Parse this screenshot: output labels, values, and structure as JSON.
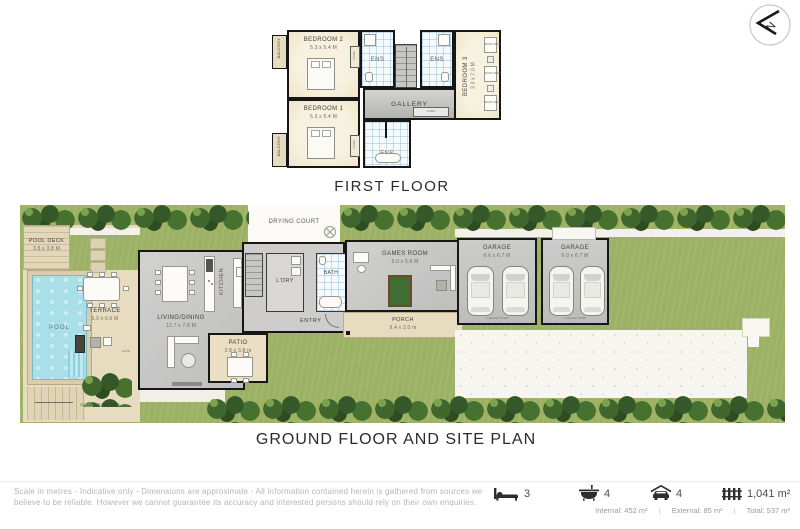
{
  "titles": {
    "first_floor": "FIRST FLOOR",
    "ground_floor": "GROUND FLOOR AND SITE PLAN"
  },
  "compass": {
    "direction": "N"
  },
  "first_floor": {
    "balcony_top": "BALCONY",
    "balcony_bottom": "BALCONY",
    "bedroom2": {
      "name": "BEDROOM 2",
      "dims": "5.3 x 5.4 M"
    },
    "bedroom1": {
      "name": "BEDROOM 1",
      "dims": "5.3 x 5.4 M"
    },
    "bedroom3": {
      "name": "BEDROOM 3",
      "dims": "3.3 x 7.0 M"
    },
    "ens_a": "ENS",
    "ens_b": "ENS",
    "ens_c": "ENS",
    "gallery": "GALLERY",
    "robe": "ROBE",
    "linen": "LINEN",
    "bunk": "BUNK BED"
  },
  "ground_floor": {
    "drying_court": "DRYING COURT",
    "pool_deck": {
      "name": "POOL DECK",
      "dims": "3.8 x 3.8 M"
    },
    "pool": "POOL",
    "terrace": {
      "name": "TERRACE",
      "dims": "5.0 x 6.6 M"
    },
    "living": {
      "name": "LIVING/DINING",
      "dims": "12.7 x 7.8 M"
    },
    "kitchen": "KITCHEN",
    "laundry": "L'DRY",
    "bath": "BATH",
    "entry": "ENTRY",
    "patio": {
      "name": "PATIO",
      "dims": "3.8 x 3.8 m"
    },
    "games_room": {
      "name": "GAMES ROOM",
      "dims": "9.0 x 5.6 M"
    },
    "porch": {
      "name": "PORCH",
      "dims": "9.4 x 2.0 m"
    },
    "garage_left": {
      "name": "GARAGE",
      "dims": "6.6 x 6.7 M",
      "door": "GARAGE DOOR"
    },
    "garage_right": {
      "name": "GARAGE",
      "dims": "6.0 x 6.7 M",
      "door": "GARAGE DOOR"
    },
    "outdoor_shower": "OUTDOOR SHOWER",
    "gate": "GATE"
  },
  "footer": {
    "disclaimer_line1": "Scale in metres - Indicative only - Dimensions are approximate - All information contained herein is gathered from sources we",
    "disclaimer_line2": "believe to be reliable.  However we cannot guarantee its accuracy and interested persons should rely on their own enquiries.",
    "beds": "3",
    "baths": "4",
    "cars": "4",
    "land_area": "1,041 m²",
    "internal": "Internal: 452 m²",
    "external": "External: 85 m²",
    "total": "Total: 537 m²",
    "sep": "|"
  },
  "colors": {
    "lawn": "#9cb164",
    "pool_water": "#a9dfe9",
    "floor_gray": "#c7c7c5",
    "timber_beige": "#e7dcbf",
    "wall": "#161616",
    "tree": "#40662e"
  }
}
